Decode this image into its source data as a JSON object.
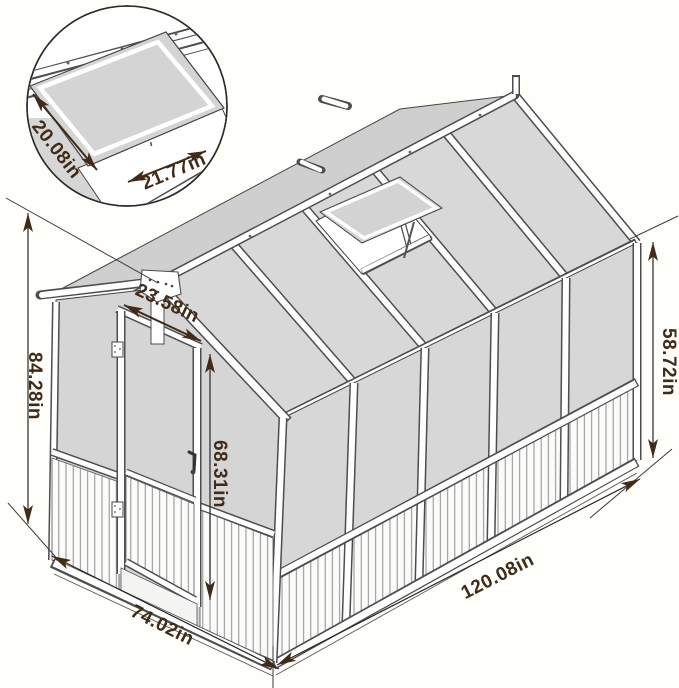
{
  "diagram": {
    "inset": {
      "vent_width": "20.08in",
      "vent_length": "21.77in"
    },
    "main": {
      "overall_height": "84.28in",
      "door_width": "23.58in",
      "door_height": "68.31in",
      "side_wall_height": "58.72in",
      "side_length": "120.08in",
      "front_width": "74.02in"
    },
    "colors": {
      "dimension_text": "#3f2b18",
      "structure_line": "#4a4a4a",
      "glass_panel": "#d7d7d7",
      "background": "#fffefb"
    }
  }
}
